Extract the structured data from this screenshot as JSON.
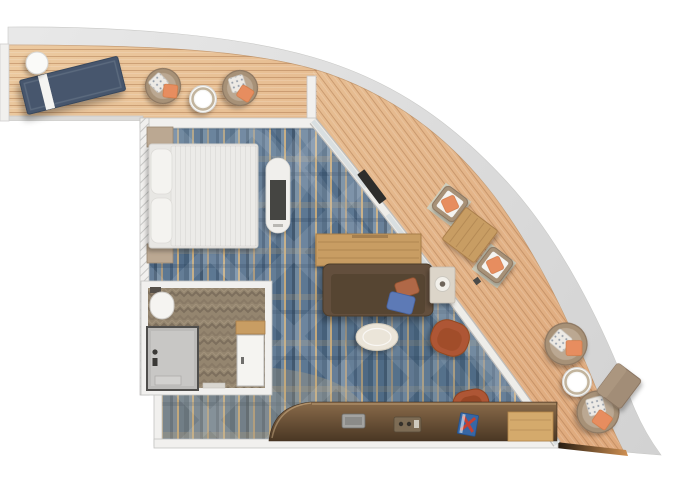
{
  "plan": {
    "kind": "cruise-suite-floor-plan",
    "objects": [
      "hull-band",
      "balcony-deck",
      "carpet",
      "bedroom",
      "bathroom",
      "lounge-daybed",
      "round-side-table",
      "wicker-chair",
      "round-table",
      "double-bed",
      "nightstand",
      "tv-console",
      "wall-tv",
      "dining-table",
      "sofa",
      "table-lamp",
      "coffee-table",
      "armchair",
      "desk-chair",
      "minibar-counter",
      "counter-sink",
      "amenity-tray",
      "game-box",
      "serving-board",
      "balcony-dining-table",
      "balcony-dining-chair",
      "ottoman",
      "shower",
      "washbasin",
      "bathroom-door"
    ]
  },
  "palette": {
    "hull_light": "#e9e9e9",
    "hull_dark": "#d2d2d2",
    "deck_light": "#eccaa0",
    "deck_dark": "#dfa97c",
    "plank": "#a9744a",
    "wall": "#f1f0ee",
    "wall_edge": "#c4c3c1",
    "carpet_base": "#5b7590",
    "carpet_dark": "#46607a",
    "carpet_mid": "#6d87a0",
    "carpet_tan": "#c3a87c",
    "bath_floor": "#94856f",
    "bath_chevron": "#7d6f5d",
    "shower_gray": "#bcbbb9",
    "white_fixture": "#f5f4f1",
    "bed_base": "#e8e7e4",
    "pillow_white": "#f4f3f0",
    "navy": "#46566d",
    "wicker_out": "#a79177",
    "wicker_in": "#bba892",
    "orange": "#e78d5e",
    "dot_pillow": "#edeae5",
    "wood": "#c89d63",
    "wood_edge": "#a87e49",
    "sofa": "#63503d",
    "sofa_seat": "#564433",
    "blue_pillow": "#5d7ab6",
    "rust_pillow": "#b06847",
    "cream": "#ebe5d9",
    "side_table": "#dcd5c9",
    "rust": "#ae5634",
    "counter_hi": "#8a6b4a",
    "counter_lo": "#4a3724",
    "tv_dark": "#454543",
    "tv_shell": "#f0efec",
    "book_blue": "#3767a5",
    "book_red": "#c44134",
    "board": "#d4aa6c",
    "ottoman": "#a28d77",
    "mat_sage": "#cdd2c4",
    "fascia_amber": "#cf9052",
    "fascia_dark": "#241a10"
  }
}
